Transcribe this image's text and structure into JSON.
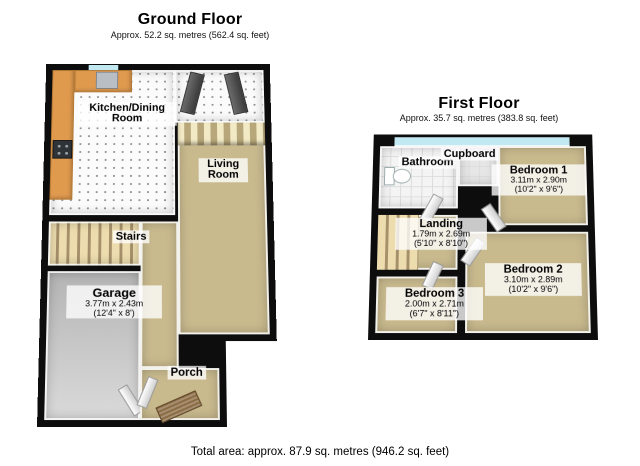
{
  "ground_floor": {
    "title": "Ground Floor",
    "subtitle": "Approx. 52.2 sq. metres (562.4 sq. feet)",
    "rooms": {
      "kitchen": {
        "name": "Kitchen/Dining Room"
      },
      "living": {
        "name": "Living Room"
      },
      "stairs": {
        "name": "Stairs"
      },
      "garage": {
        "name": "Garage",
        "dims_m": "3.77m x 2.43m",
        "dims_ft": "(12'4\" x 8')"
      },
      "porch": {
        "name": "Porch"
      }
    }
  },
  "first_floor": {
    "title": "First Floor",
    "subtitle": "Approx. 35.7 sq. metres (383.8 sq. feet)",
    "rooms": {
      "bathroom": {
        "name": "Bathroom"
      },
      "cupboard": {
        "name": "Cupboard"
      },
      "bedroom1": {
        "name": "Bedroom 1",
        "dims_m": "3.11m x 2.90m",
        "dims_ft": "(10'2\" x 9'6\")"
      },
      "landing": {
        "name": "Landing",
        "dims_m": "1.79m x 2.69m",
        "dims_ft": "(5'10\" x 8'10\")"
      },
      "bedroom2": {
        "name": "Bedroom 2",
        "dims_m": "3.10m x 2.89m",
        "dims_ft": "(10'2\" x 9'6\")"
      },
      "bedroom3": {
        "name": "Bedroom 3",
        "dims_m": "2.00m x 2.71m",
        "dims_ft": "(6'7\" x 8'11\")"
      }
    }
  },
  "footer": {
    "total_area": "Total area: approx. 87.9 sq. metres (946.2 sq. feet)"
  },
  "colors": {
    "wall": "#0d0d0d",
    "carpet": "#c9ba8e",
    "cabinet": "#e09a4e",
    "window": "#c2e8f2",
    "curtain_light": "#f2e9c5",
    "curtain_dark": "#b7a77a",
    "stairs_light": "#ecdcae",
    "stairs_dark": "#a5906a"
  }
}
